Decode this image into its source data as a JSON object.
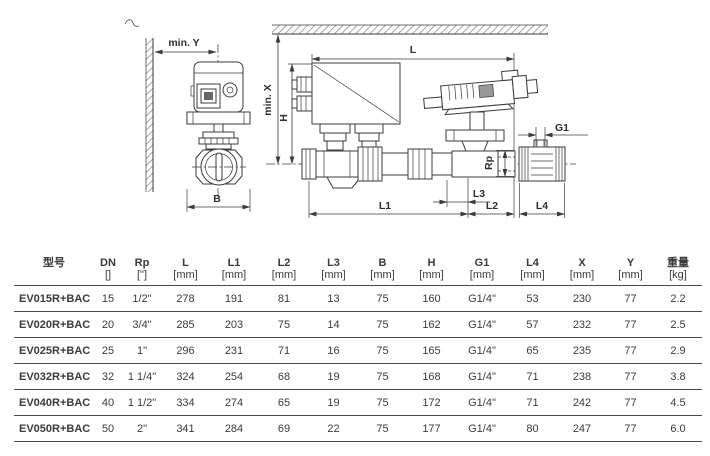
{
  "colors": {
    "line": "#3b3b3b",
    "text": "#2f2f2f",
    "hatch": "#8a8a8a",
    "table_border": "#4a4a4a",
    "background": "#ffffff"
  },
  "diagram": {
    "front_view": {
      "labels": {
        "min_y": "min. Y",
        "b": "B"
      }
    },
    "side_view": {
      "labels": {
        "l": "L",
        "min_x": "min. X",
        "h": "H",
        "l1": "L1",
        "l2": "L2",
        "l3": "L3",
        "l4": "L4",
        "g1": "G1",
        "rp": "Rp"
      }
    }
  },
  "table": {
    "columns": [
      {
        "label": "型号",
        "unit": ""
      },
      {
        "label": "DN",
        "unit": "[]"
      },
      {
        "label": "Rp",
        "unit": "[\"]"
      },
      {
        "label": "L",
        "unit": "[mm]"
      },
      {
        "label": "L1",
        "unit": "[mm]"
      },
      {
        "label": "L2",
        "unit": "[mm]"
      },
      {
        "label": "L3",
        "unit": "[mm]"
      },
      {
        "label": "B",
        "unit": "[mm]"
      },
      {
        "label": "H",
        "unit": "[mm]"
      },
      {
        "label": "G1",
        "unit": "[mm]"
      },
      {
        "label": "L4",
        "unit": "[mm]"
      },
      {
        "label": "X",
        "unit": "[mm]"
      },
      {
        "label": "Y",
        "unit": "[mm]"
      },
      {
        "label": "重量",
        "unit": "[kg]"
      }
    ],
    "rows": [
      [
        "EV015R+BAC",
        "15",
        "1/2\"",
        "278",
        "191",
        "81",
        "13",
        "75",
        "160",
        "G1/4\"",
        "53",
        "230",
        "77",
        "2.2"
      ],
      [
        "EV020R+BAC",
        "20",
        "3/4\"",
        "285",
        "203",
        "75",
        "14",
        "75",
        "162",
        "G1/4\"",
        "57",
        "232",
        "77",
        "2.5"
      ],
      [
        "EV025R+BAC",
        "25",
        "1\"",
        "296",
        "231",
        "71",
        "16",
        "75",
        "165",
        "G1/4\"",
        "65",
        "235",
        "77",
        "2.9"
      ],
      [
        "EV032R+BAC",
        "32",
        "1 1/4\"",
        "324",
        "254",
        "68",
        "19",
        "75",
        "168",
        "G1/4\"",
        "71",
        "238",
        "77",
        "3.8"
      ],
      [
        "EV040R+BAC",
        "40",
        "1 1/2\"",
        "334",
        "274",
        "65",
        "19",
        "75",
        "172",
        "G1/4\"",
        "71",
        "242",
        "77",
        "4.5"
      ],
      [
        "EV050R+BAC",
        "50",
        "2\"",
        "341",
        "284",
        "69",
        "22",
        "75",
        "177",
        "G1/4\"",
        "80",
        "247",
        "77",
        "6.0"
      ]
    ]
  }
}
